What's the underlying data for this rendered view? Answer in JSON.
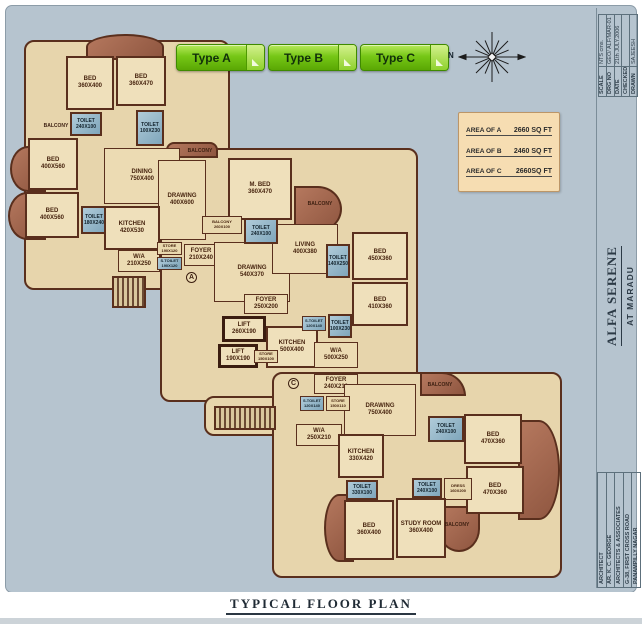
{
  "caption": "TYPICAL FLOOR PLAN",
  "toolbar": {
    "buttons": [
      {
        "label": "Type A"
      },
      {
        "label": "Type B"
      },
      {
        "label": "Type C"
      }
    ]
  },
  "compass": {
    "north_label": "N"
  },
  "area_table": {
    "rows": [
      {
        "label": "AREA OF A",
        "value": "2660 SQ FT"
      },
      {
        "label": "AREA OF B",
        "value": "2460 SQ FT"
      },
      {
        "label": "AREA OF C",
        "value": "2660SQ FT"
      }
    ]
  },
  "title_block": {
    "info_rows": [
      {
        "label": "SCALE",
        "value": "NTS cms."
      },
      {
        "label": "DRG NO",
        "value": "GEO/ ALF/MAR-01"
      },
      {
        "label": "DATE",
        "value": "21th JULY.2006"
      },
      {
        "label": "CHECKED",
        "value": ""
      },
      {
        "label": "DRAWN",
        "value": "SAJEESH"
      }
    ],
    "project_name": "ALFA SERENE",
    "project_location": "AT MARADU",
    "architect_rows": [
      "ARCHITECT",
      "AR. K. C. GEORGE",
      "ARCHITECTS & ASSOCIATES",
      "G-38, FIRST CROSS ROAD",
      "PANAMPILLY NAGAR"
    ]
  },
  "colors": {
    "accent_green": "#76c716",
    "sheet_blue": "#b6c4cf",
    "plan_beige": "#ecdbb3",
    "wall_brown": "#5a2f1d",
    "toilet_blue": "#8fb2c6",
    "balcony_brown": "#a06651"
  },
  "floor_plan": {
    "footprints": [
      {
        "x": 24,
        "y": 40,
        "w": 206,
        "h": 250
      },
      {
        "x": 160,
        "y": 148,
        "w": 258,
        "h": 254
      },
      {
        "x": 204,
        "y": 396,
        "w": 82,
        "h": 40
      },
      {
        "x": 272,
        "y": 372,
        "w": 290,
        "h": 206
      }
    ],
    "balconies": [
      {
        "x": 86,
        "y": 34,
        "w": 78,
        "h": 26,
        "r": "50% 50% 0 0"
      },
      {
        "x": 10,
        "y": 146,
        "w": 36,
        "h": 46,
        "r": "50% 0 0 50%"
      },
      {
        "x": 8,
        "y": 192,
        "w": 38,
        "h": 48,
        "r": "50% 0 0 50%"
      },
      {
        "x": 166,
        "y": 142,
        "w": 52,
        "h": 16,
        "r": "8px 8px 0 0"
      },
      {
        "x": 294,
        "y": 186,
        "w": 48,
        "h": 46,
        "r": "0 50% 50% 0"
      },
      {
        "x": 420,
        "y": 372,
        "w": 46,
        "h": 24,
        "r": "0 24px 0 0"
      },
      {
        "x": 518,
        "y": 420,
        "w": 42,
        "h": 100,
        "r": "0 50% 50% 0"
      },
      {
        "x": 324,
        "y": 494,
        "w": 30,
        "h": 68,
        "r": "50% 0 0 50%"
      },
      {
        "x": 438,
        "y": 506,
        "w": 42,
        "h": 46,
        "r": "0 0 50% 50%"
      }
    ],
    "stairs": [
      {
        "x": 112,
        "y": 276,
        "w": 34,
        "h": 32
      },
      {
        "x": 214,
        "y": 406,
        "w": 62,
        "h": 24
      }
    ],
    "rooms": [
      {
        "label": "DINING\n750X400",
        "x": 104,
        "y": 148,
        "w": 76,
        "h": 56,
        "type": "open"
      },
      {
        "label": "DRAWING\n400X600",
        "x": 158,
        "y": 160,
        "w": 48,
        "h": 80,
        "type": "open"
      },
      {
        "label": "W/A\n210X250",
        "x": 118,
        "y": 250,
        "w": 42,
        "h": 22,
        "type": "open"
      },
      {
        "label": "BED\n360X400",
        "x": 66,
        "y": 56,
        "w": 48,
        "h": 54,
        "type": "room"
      },
      {
        "label": "BED\n360X470",
        "x": 116,
        "y": 56,
        "w": 50,
        "h": 50,
        "type": "room"
      },
      {
        "label": "TOILET\n240X100",
        "x": 70,
        "y": 112,
        "w": 32,
        "h": 24,
        "type": "toilet"
      },
      {
        "label": "TOILET\n100X230",
        "x": 136,
        "y": 110,
        "w": 28,
        "h": 36,
        "type": "toilet"
      },
      {
        "label": "BED\n400X560",
        "x": 28,
        "y": 138,
        "w": 50,
        "h": 52,
        "type": "room"
      },
      {
        "label": "BED\n400X560",
        "x": 25,
        "y": 192,
        "w": 54,
        "h": 46,
        "type": "room"
      },
      {
        "label": "TOILET\n180X240",
        "x": 81,
        "y": 206,
        "w": 26,
        "h": 28,
        "type": "toilet"
      },
      {
        "label": "KITCHEN\n420X530",
        "x": 104,
        "y": 206,
        "w": 56,
        "h": 44,
        "type": "room"
      },
      {
        "label": "FOYER\n210X240",
        "x": 184,
        "y": 244,
        "w": 34,
        "h": 22,
        "type": "open"
      },
      {
        "label": "STORE\n190X120",
        "x": 157,
        "y": 242,
        "w": 25,
        "h": 13,
        "type": "small"
      },
      {
        "label": "S.TOILET\n190X120",
        "x": 157,
        "y": 257,
        "w": 25,
        "h": 13,
        "type": "small-toilet"
      },
      {
        "label": "M. BED\n360X470",
        "x": 228,
        "y": 158,
        "w": 64,
        "h": 62,
        "type": "room"
      },
      {
        "label": "DRAWING\n540X370",
        "x": 214,
        "y": 242,
        "w": 76,
        "h": 60,
        "type": "open"
      },
      {
        "label": "LIVING\n400X380",
        "x": 272,
        "y": 224,
        "w": 66,
        "h": 50,
        "type": "open"
      },
      {
        "label": "BALCONY\n260X100",
        "x": 202,
        "y": 216,
        "w": 40,
        "h": 18,
        "type": "small"
      },
      {
        "label": "TOILET\n240X100",
        "x": 244,
        "y": 218,
        "w": 34,
        "h": 26,
        "type": "toilet"
      },
      {
        "label": "TOILET\n140X250",
        "x": 326,
        "y": 244,
        "w": 24,
        "h": 34,
        "type": "toilet"
      },
      {
        "label": "BED\n450X360",
        "x": 352,
        "y": 232,
        "w": 56,
        "h": 48,
        "type": "room"
      },
      {
        "label": "BED\n410X360",
        "x": 352,
        "y": 282,
        "w": 56,
        "h": 44,
        "type": "room"
      },
      {
        "label": "FOYER\n250X200",
        "x": 244,
        "y": 294,
        "w": 44,
        "h": 20,
        "type": "open"
      },
      {
        "label": "LIFT\n260X190",
        "x": 222,
        "y": 316,
        "w": 44,
        "h": 26,
        "type": "core"
      },
      {
        "label": "LIFT\n190X190",
        "x": 218,
        "y": 344,
        "w": 40,
        "h": 24,
        "type": "core"
      },
      {
        "label": "KITCHEN\n500X400",
        "x": 266,
        "y": 326,
        "w": 52,
        "h": 42,
        "type": "room"
      },
      {
        "label": "STORE\n150X100",
        "x": 254,
        "y": 350,
        "w": 24,
        "h": 13,
        "type": "small"
      },
      {
        "label": "S.TOILET\n120X140",
        "x": 302,
        "y": 316,
        "w": 24,
        "h": 15,
        "type": "small-toilet"
      },
      {
        "label": "TOILET\n100X230",
        "x": 328,
        "y": 314,
        "w": 24,
        "h": 24,
        "type": "toilet"
      },
      {
        "label": "W/A\n500X250",
        "x": 314,
        "y": 342,
        "w": 44,
        "h": 26,
        "type": "open"
      },
      {
        "label": "FOYER\n240X210",
        "x": 314,
        "y": 374,
        "w": 44,
        "h": 20,
        "type": "open"
      },
      {
        "label": "DRAWING\n750X400",
        "x": 344,
        "y": 384,
        "w": 72,
        "h": 52,
        "type": "open"
      },
      {
        "label": "S.TOILET\n120X140",
        "x": 300,
        "y": 396,
        "w": 24,
        "h": 15,
        "type": "small-toilet"
      },
      {
        "label": "STORE\n150X110",
        "x": 326,
        "y": 396,
        "w": 24,
        "h": 15,
        "type": "small"
      },
      {
        "label": "W/A\n250X210",
        "x": 296,
        "y": 424,
        "w": 46,
        "h": 22,
        "type": "open"
      },
      {
        "label": "KITCHEN\n330X420",
        "x": 338,
        "y": 434,
        "w": 46,
        "h": 44,
        "type": "room"
      },
      {
        "label": "TOILET\n330X100",
        "x": 346,
        "y": 480,
        "w": 32,
        "h": 20,
        "type": "toilet"
      },
      {
        "label": "TOILET\n240X100",
        "x": 428,
        "y": 416,
        "w": 36,
        "h": 26,
        "type": "toilet"
      },
      {
        "label": "BED\n470X360",
        "x": 464,
        "y": 414,
        "w": 58,
        "h": 50,
        "type": "room"
      },
      {
        "label": "BED\n470X360",
        "x": 466,
        "y": 466,
        "w": 58,
        "h": 48,
        "type": "room"
      },
      {
        "label": "TOILET\n240X100",
        "x": 412,
        "y": 478,
        "w": 30,
        "h": 20,
        "type": "toilet"
      },
      {
        "label": "DRESS\n160X200",
        "x": 444,
        "y": 478,
        "w": 28,
        "h": 22,
        "type": "small"
      },
      {
        "label": "BED\n360X400",
        "x": 344,
        "y": 500,
        "w": 50,
        "h": 60,
        "type": "room"
      },
      {
        "label": "STUDY ROOM\n360X400",
        "x": 396,
        "y": 498,
        "w": 50,
        "h": 60,
        "type": "room"
      }
    ],
    "labels": [
      {
        "text": "BALCONY",
        "x": 36,
        "y": 121,
        "w": 40
      },
      {
        "text": "BALCONY",
        "x": 178,
        "y": 146,
        "w": 44
      },
      {
        "text": "BALCONY",
        "x": 298,
        "y": 199,
        "w": 44
      },
      {
        "text": "BALCONY",
        "x": 418,
        "y": 380,
        "w": 44
      },
      {
        "text": "BALCONY",
        "x": 434,
        "y": 520,
        "w": 46
      }
    ],
    "markers": [
      {
        "text": "A",
        "x": 186,
        "y": 272
      },
      {
        "text": "C",
        "x": 288,
        "y": 378
      }
    ]
  }
}
